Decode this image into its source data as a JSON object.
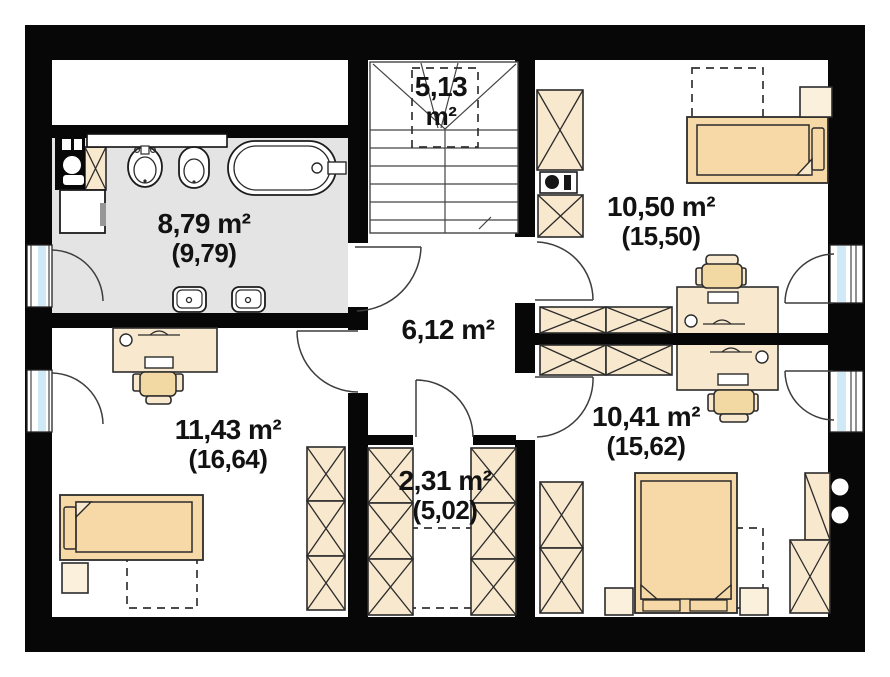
{
  "title": "attic-floor-plan",
  "unit": "m²",
  "colors": {
    "wall": "#070707",
    "bathroom_floor": "#e4e4e4",
    "furniture_fill": "#f8e8cd",
    "bed_fill": "#f6d9a6",
    "glass": "#cfe9f6",
    "text": "#121212"
  },
  "rooms": [
    {
      "id": "staircase",
      "line1": "5,13",
      "line2": "m²"
    },
    {
      "id": "bathroom",
      "line1": "8,79 m²",
      "line2": "(9,79)"
    },
    {
      "id": "bedroom-top-right",
      "line1": "10,50 m²",
      "line2": "(15,50)"
    },
    {
      "id": "hallway",
      "line1": "6,12 m²",
      "line2": ""
    },
    {
      "id": "bedroom-bottom-left",
      "line1": "11,43 m²",
      "line2": "(16,64)"
    },
    {
      "id": "wardrobe-room",
      "line1": "2,31 m²",
      "line2": "(5,02)"
    },
    {
      "id": "bedroom-bottom-right",
      "line1": "10,41 m²",
      "line2": "(15,62)"
    }
  ]
}
